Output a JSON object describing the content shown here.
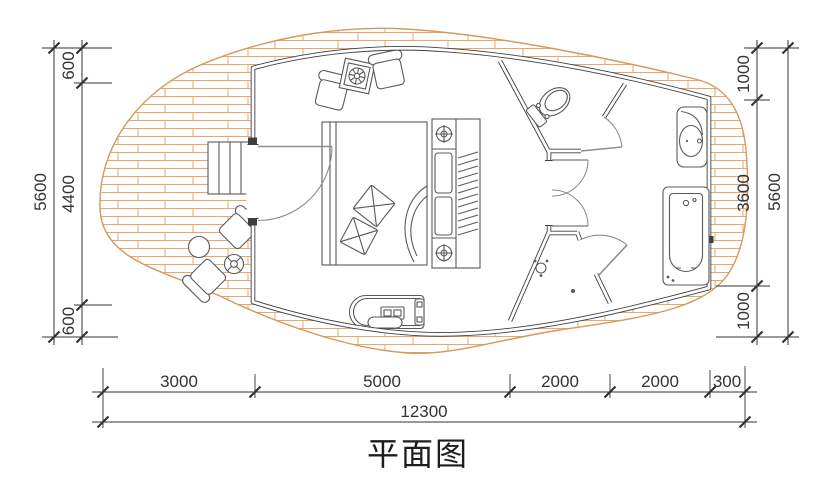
{
  "title": "平面图",
  "dimensions": {
    "left": {
      "segments": [
        "600",
        "4400",
        "600"
      ],
      "total": "5600"
    },
    "right": {
      "segments": [
        "1000",
        "3600",
        "1000"
      ],
      "total": "5600"
    },
    "bottom": {
      "segments": [
        "3000",
        "5000",
        "2000",
        "2000",
        "300"
      ],
      "total": "12300"
    }
  },
  "colors": {
    "deck_outline": "#d6985c",
    "deck_hatch": "#eaa76a",
    "wall": "#3f3f3f",
    "furniture": "#5a5a5a",
    "door": "#8f8f8f",
    "dim": "#333333"
  },
  "elements": [
    "wood-deck",
    "entry-steps",
    "entry-door",
    "outdoor-round-table",
    "outdoor-chair",
    "potted-plant",
    "lounge-chair",
    "side-table",
    "double-bed",
    "pillow",
    "headboard-downlight",
    "wardrobe",
    "tv-cabinet",
    "interior-double-door",
    "toilet",
    "toilet-door",
    "shower",
    "shower-door",
    "washbasin",
    "bathtub"
  ]
}
